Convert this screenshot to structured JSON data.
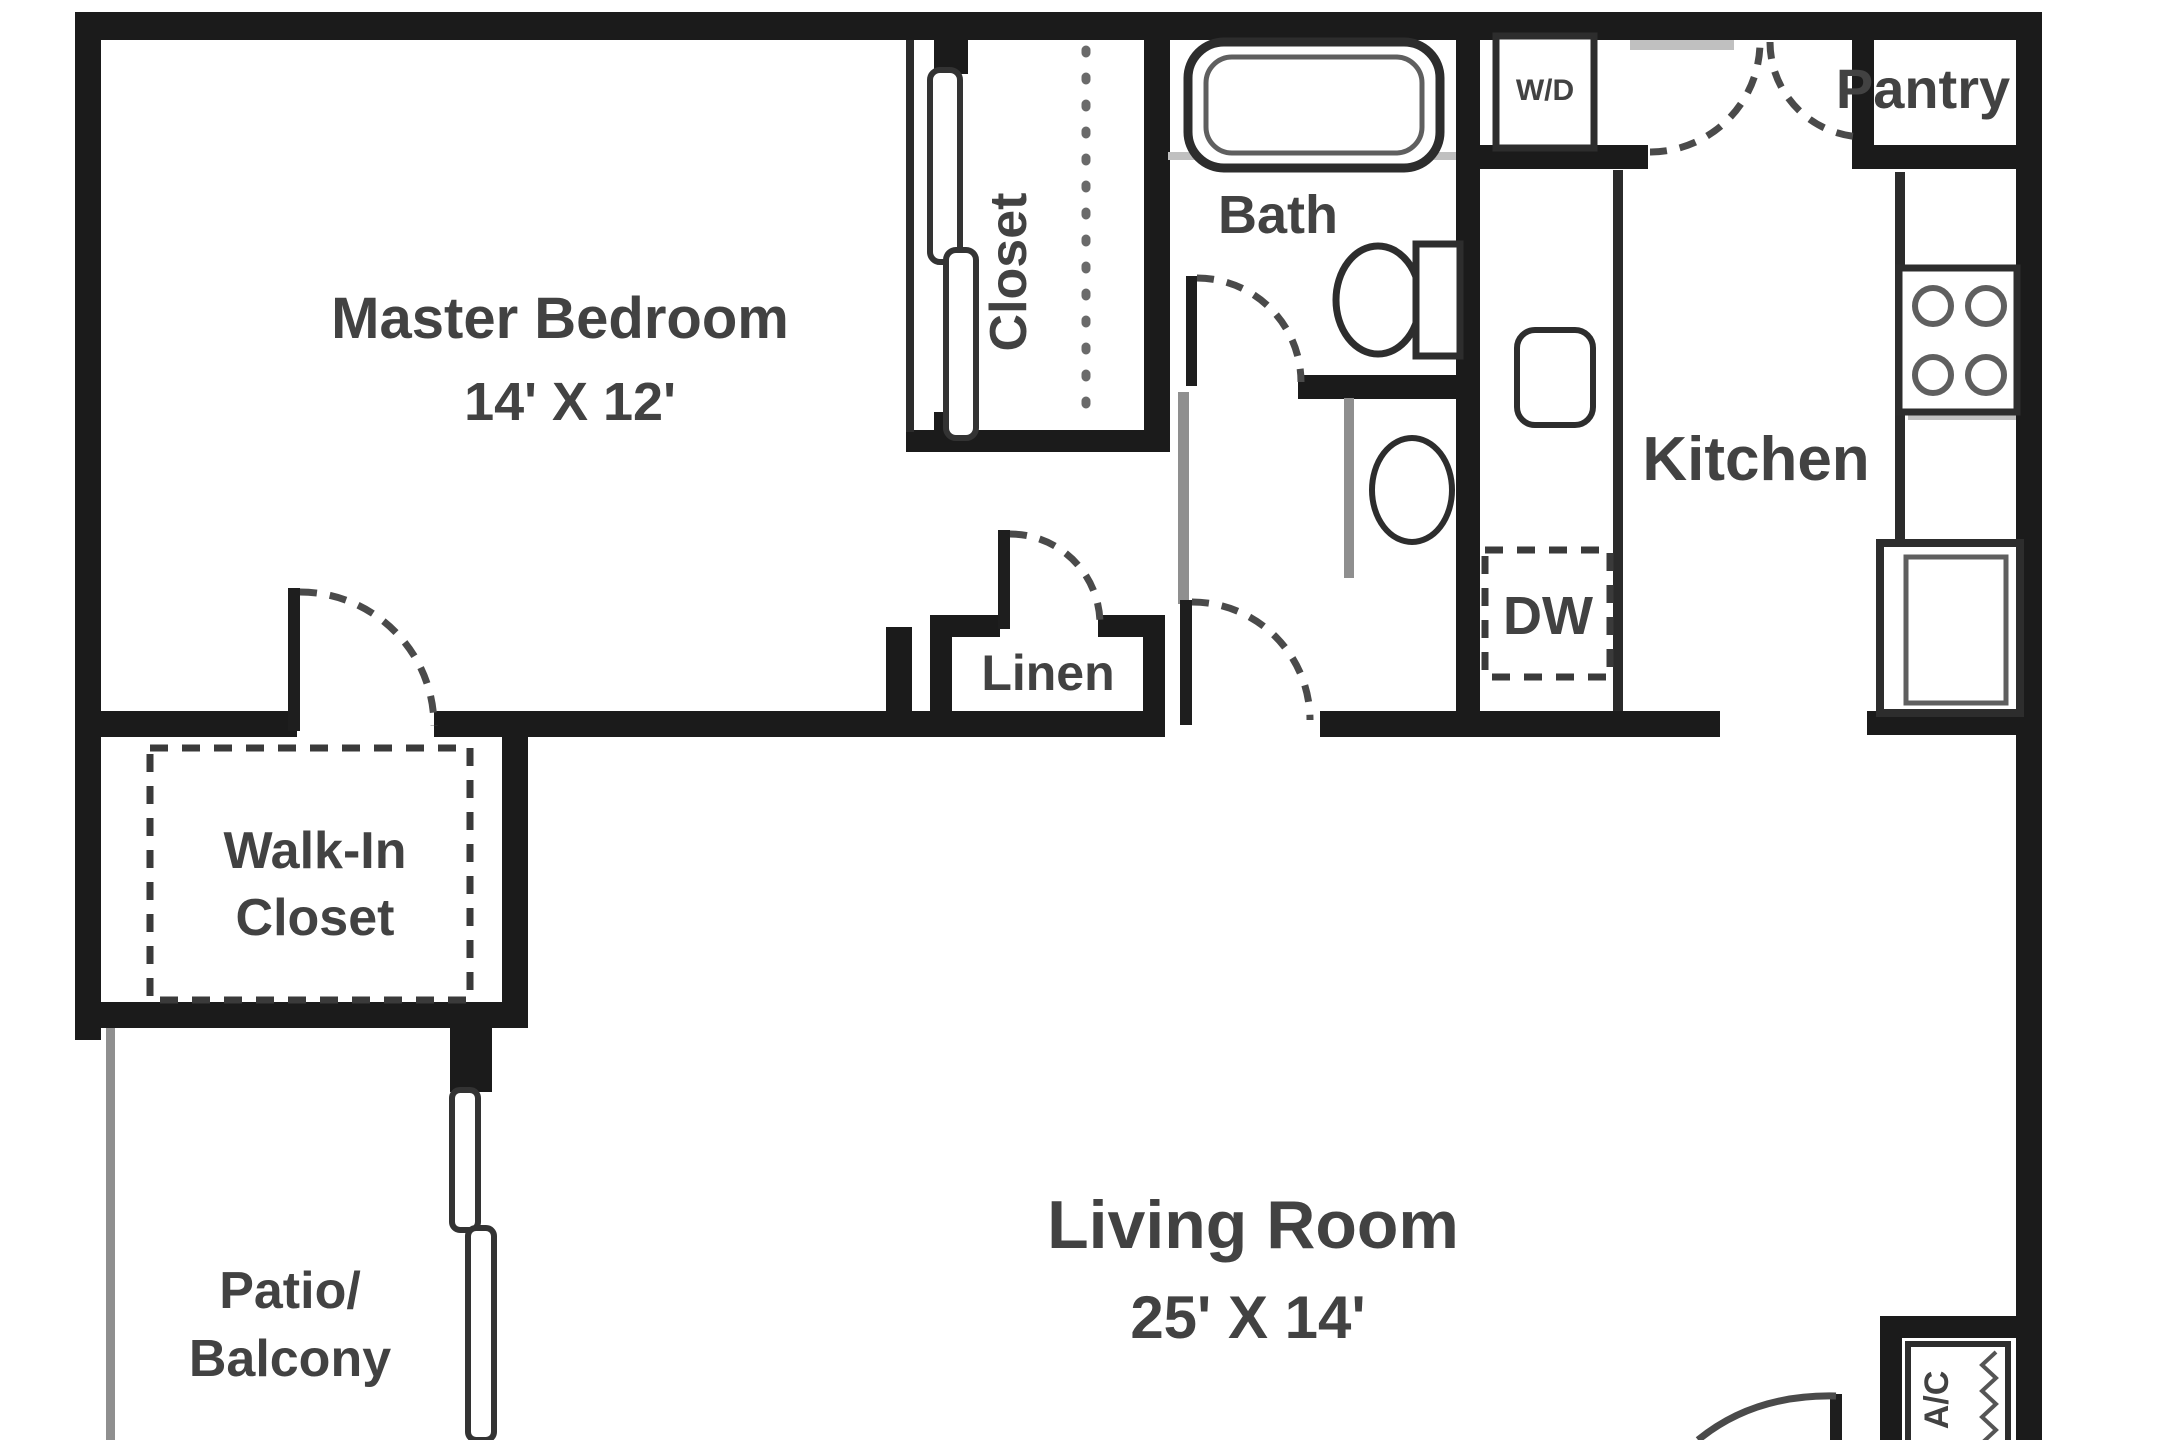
{
  "title": "Apartment floor plan",
  "colors": {
    "wall": "#1b1b1b",
    "fixture_stroke": "#2d2d2d",
    "light_line": "#8f8f8f",
    "door_arc": "#4a4a4a",
    "text": "#424242",
    "background": "#ffffff"
  },
  "rooms": {
    "master_bedroom": {
      "label": "Master Bedroom",
      "dimensions": "14' X 12'"
    },
    "closet": {
      "label": "Closet"
    },
    "bath": {
      "label": "Bath"
    },
    "linen": {
      "label": "Linen"
    },
    "walk_in_closet": {
      "label_line1": "Walk-In",
      "label_line2": "Closet"
    },
    "patio": {
      "label_line1": "Patio/",
      "label_line2": "Balcony"
    },
    "living_room": {
      "label": "Living Room",
      "dimensions": "25' X 14'"
    },
    "kitchen": {
      "label": "Kitchen"
    },
    "pantry": {
      "label": "Pantry"
    }
  },
  "appliances": {
    "washer_dryer": "W/D",
    "dishwasher": "DW",
    "air_conditioner": "A/C"
  }
}
